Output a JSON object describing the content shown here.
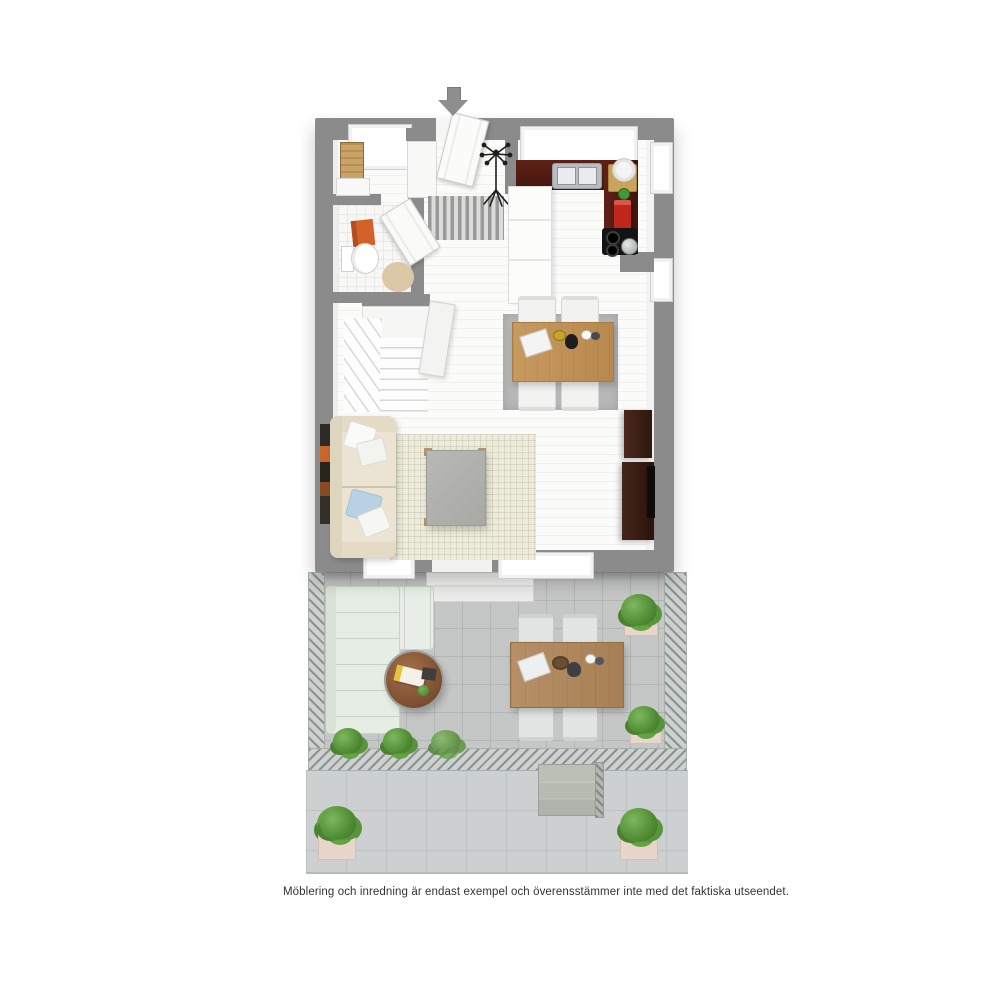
{
  "caption": "Möblering och inredning är endast exempel och överensstämmer inte med det faktiska utseendet.",
  "entrance": {
    "direction": "down",
    "icon": "entrance-arrow-down"
  },
  "palette": {
    "wall": "#8b8b8b",
    "indoor_floor": "#fbfbfa",
    "kitchen_counter": "#54200f",
    "dining_table_wood": "#c2975e",
    "round_table_wood": "#8a5a38",
    "sofa_cream": "#ece4d2",
    "ottoman_gray": "#b1b1ad",
    "tv_cabinet": "#371d12",
    "terrace_tile": "#c5c7c6",
    "patio_tile": "#cdd0d1",
    "outdoor_sofa": "#e9efe8",
    "plant_green": "#4f8c33",
    "planter_pink": "#e9d6cb",
    "towel_orange": "#d2622a",
    "appliance_red": "#c0271c",
    "accent_mat": "#8f8f8f"
  },
  "scene": {
    "rooms": [
      "hallway",
      "bathroom",
      "kitchen",
      "dining-area",
      "living-area",
      "staircase",
      "terrace",
      "lower-patio"
    ],
    "furniture": [
      "front-door",
      "coat-rack",
      "doormat",
      "radiator-ladder",
      "toilet",
      "bath-rug",
      "kitchen-sink",
      "cooktop",
      "fridge-island",
      "dining-table",
      "dining-chairs",
      "tv-sideboard",
      "sofa",
      "living-rug",
      "ottoman",
      "outdoor-corner-sofa",
      "round-coffee-table",
      "outdoor-dining-table",
      "outdoor-chairs",
      "garden-steps",
      "potted-plants"
    ]
  }
}
